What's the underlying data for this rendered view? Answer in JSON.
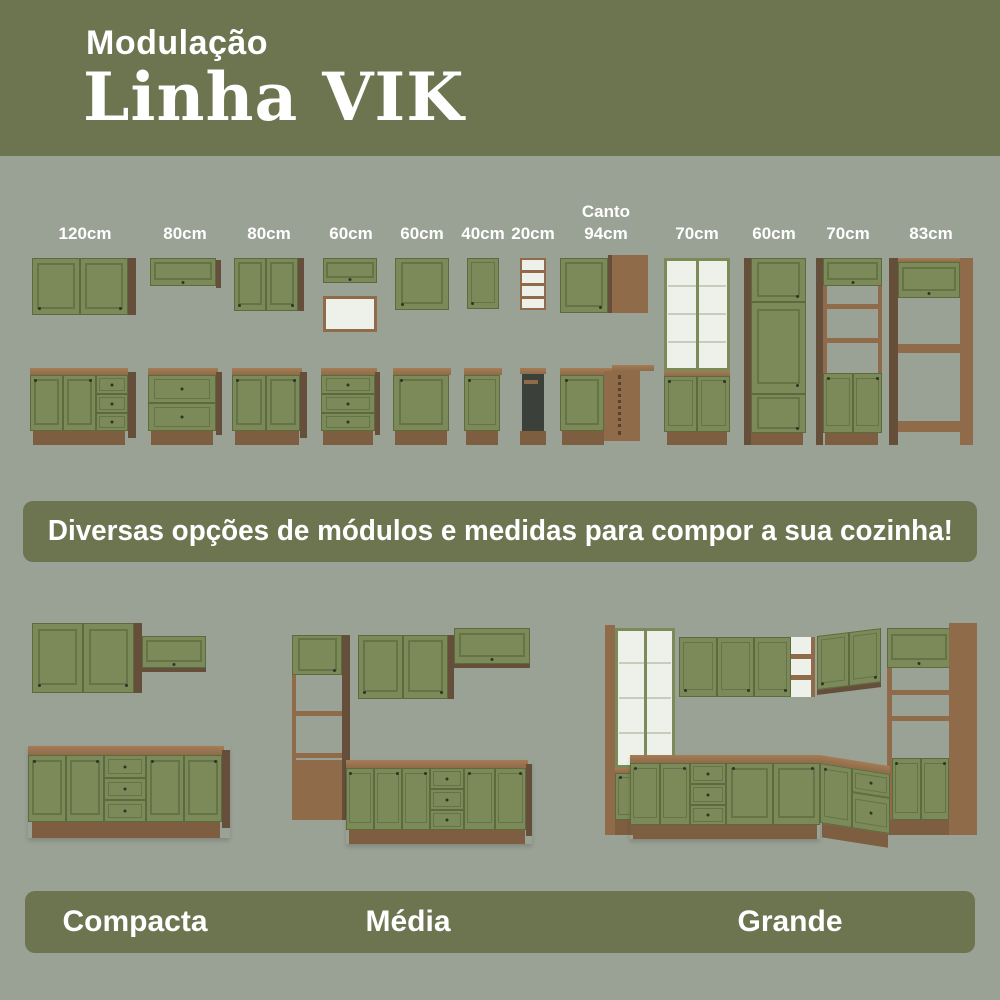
{
  "header": {
    "eyebrow": "Modulação",
    "title": "Linha VIK"
  },
  "modules": [
    {
      "label": "120cm",
      "type": "wall-2-door + base-2-door-3-drawer"
    },
    {
      "label": "80cm",
      "type": "wall-flip-door + base-2-drawer"
    },
    {
      "label": "80cm",
      "type": "wall-2-door + base-2-door"
    },
    {
      "label": "60cm",
      "type": "wall-flip-door + open-niche + base-3-drawer"
    },
    {
      "label": "60cm",
      "type": "wall-1-door + base-1-door"
    },
    {
      "label": "40cm",
      "type": "wall-1-door + base-1-door"
    },
    {
      "label": "20cm",
      "type": "open-shelf-column + base-open-niche"
    },
    {
      "label": "Canto\n94cm",
      "type": "corner-wall-cabinet + corner-base-cabinet"
    },
    {
      "label": "70cm",
      "type": "tall-glass-display-cabinet"
    },
    {
      "label": "60cm",
      "type": "tall-pantry-3-door"
    },
    {
      "label": "70cm",
      "type": "tall-oven-microwave-tower"
    },
    {
      "label": "83cm",
      "type": "refrigerator-surround-cabinet"
    }
  ],
  "banner": {
    "text": "Diversas opções de módulos e medidas para compor a sua cozinha!"
  },
  "kitchens": [
    {
      "label": "Compacta"
    },
    {
      "label": "Média"
    },
    {
      "label": "Grande"
    }
  ],
  "colors": {
    "olive": "#6d7450",
    "background": "#9aa195",
    "cabinet_green": "#7b8a58",
    "cabinet_green_dark": "#5c6b3e",
    "panel_line": "#647447",
    "wood": "#8f6b49",
    "wood_light": "#a47c55",
    "wood_dark": "#654f3b",
    "plinth": "#7d5e41",
    "interior_white": "#eef0ea",
    "dark_opening": "#3c403b",
    "text_white": "#ffffff"
  }
}
